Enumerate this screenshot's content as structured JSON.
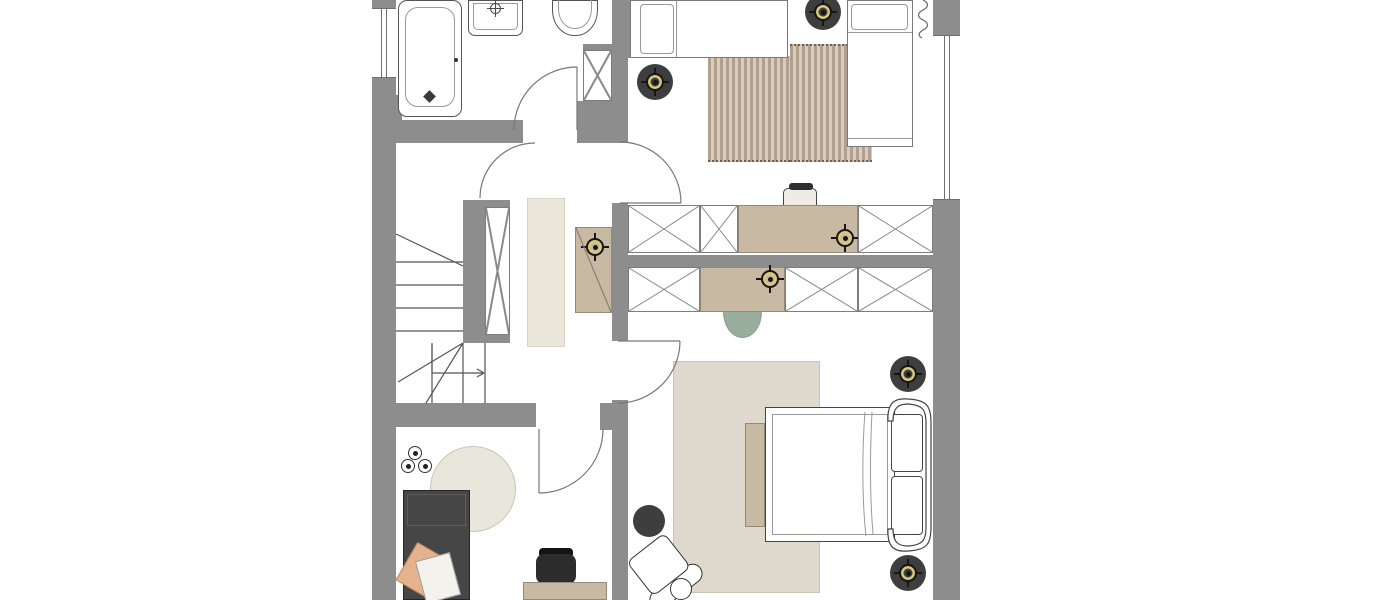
{
  "meta": {
    "view": "floor-plan-top-view",
    "visible_text": "none",
    "plan_extent_px": {
      "left": 372,
      "right": 960,
      "top": 0,
      "bottom": 600
    }
  },
  "colors": {
    "wall": "#8d8d8d",
    "tan": "#c8b9a3",
    "tan-border": "#958a77",
    "gold": "#d8c87c",
    "disc": "#3e3e3e",
    "stripe-a": "#b2a08f",
    "stripe-b": "#d7ccbd",
    "rug-runner": "#eae6da",
    "rug-round": "#e9e6db",
    "rug-big": "#ded9cc",
    "sage": "#9bae9e",
    "sofa": "#464646",
    "peach": "#e6b28b",
    "line": "#555555"
  },
  "rooms": [
    {
      "name": "bathroom",
      "position": "top-left",
      "fixtures": [
        "bathtub",
        "washbasin",
        "toilet",
        "tall-cabinet",
        "door-swing"
      ]
    },
    {
      "name": "hallway-staircase",
      "position": "middle-left",
      "fixtures": [
        "winder-staircase",
        "stair-direction-arrow",
        "shaft-x",
        "runner-rug",
        "sideboard",
        "ceiling-light-symbol",
        "door-swings"
      ]
    },
    {
      "name": "bedroom-upper",
      "position": "top-right",
      "fixtures": [
        "single-bed-horizontal",
        "single-bed-vertical",
        "curtain-squiggle",
        "striped-rug",
        "desk-with-light",
        "desk-chair",
        "wardrobe-x-boxes",
        "ceiling-light-disc",
        "ceiling-light-disc"
      ]
    },
    {
      "name": "bedroom-lower",
      "position": "bottom-right",
      "fixtures": [
        "double-bed-curved-headboard",
        "area-rug",
        "bench",
        "dresser-with-light",
        "wardrobe-x-boxes",
        "sage-half-round-table",
        "dark-stool",
        "lounge-chair",
        "side-table",
        "ceiling-light-disc",
        "ceiling-light-disc"
      ]
    },
    {
      "name": "office",
      "position": "bottom-left",
      "fixtures": [
        "daybed-dark",
        "cushion-peach",
        "cushion-white",
        "round-rug",
        "pendant-lamp-3-bulb",
        "desk",
        "office-chair",
        "door-swing"
      ]
    }
  ],
  "symbol_counts": {
    "ceiling-light-disc": 6,
    "light-symbol-on-furniture": 2,
    "door-swings": 5,
    "wardrobe-x-boxes": 8,
    "windows": 2
  }
}
